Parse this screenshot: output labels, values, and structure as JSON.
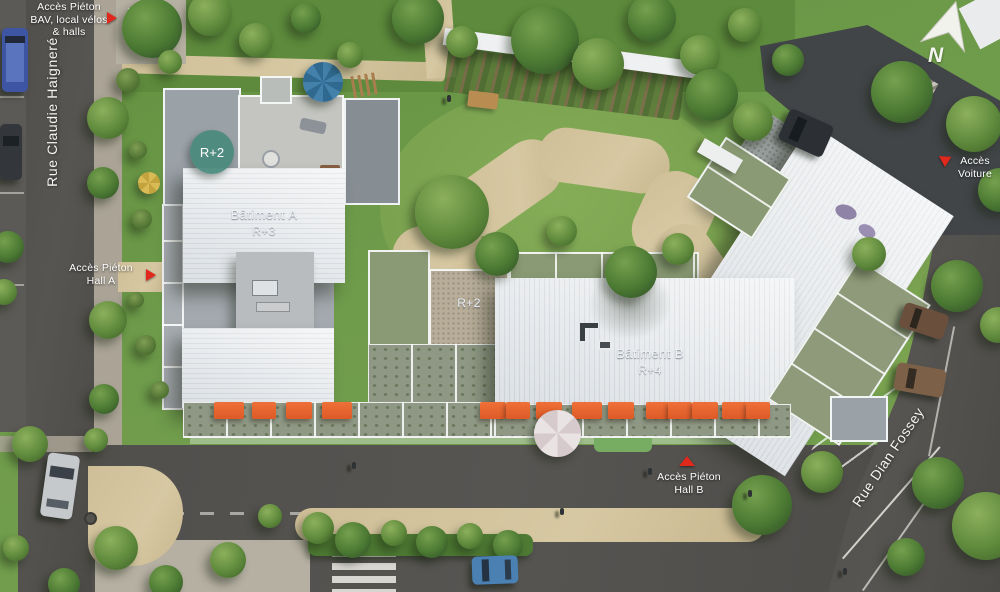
{
  "plan": {
    "streets": {
      "left": "Rue Claudie Haigneré",
      "right": "Rue Dian Fossey"
    },
    "buildings": {
      "a": {
        "name": "Bâtiment A",
        "floors": "R+3"
      },
      "b": {
        "name": "Bâtiment B",
        "floors": "R+4"
      },
      "annex_badge": "R+2",
      "annex_roof": "R+2"
    },
    "access": {
      "bav": {
        "line1": "Accès Piéton",
        "line2": "BAV, local vélos",
        "line3": "& halls"
      },
      "hall_a": {
        "line1": "Accès Piéton",
        "line2": "Hall A"
      },
      "voiture": {
        "line1": "Accès",
        "line2": "Voiture"
      },
      "hall_b": {
        "line1": "Accès Piéton",
        "line2": "Hall B"
      }
    },
    "compass": {
      "north": "N"
    },
    "colors": {
      "accent_red": "#e0281c",
      "badge_teal": "#4a8a7d",
      "awning_orange": "#e4622e",
      "roof_white": "#edeff1"
    }
  }
}
